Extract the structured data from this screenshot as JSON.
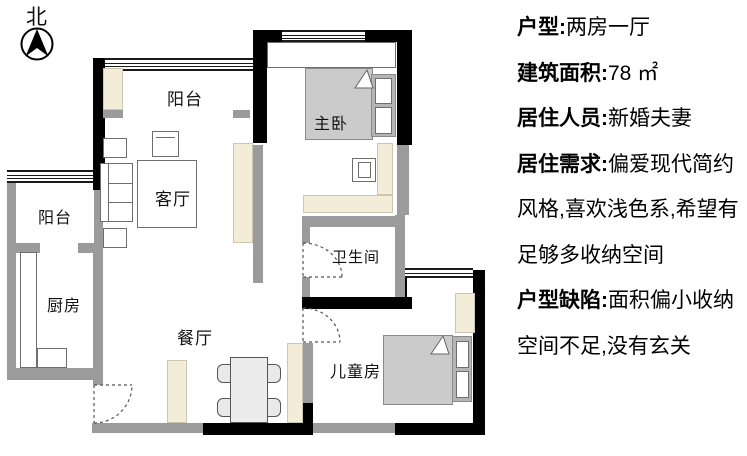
{
  "compass": {
    "label": "北"
  },
  "rooms": [
    {
      "id": "balcony-top",
      "label": "阳台"
    },
    {
      "id": "master-bedroom",
      "label": "主卧"
    },
    {
      "id": "living-room",
      "label": "客厅"
    },
    {
      "id": "balcony-left",
      "label": "阳台"
    },
    {
      "id": "kitchen",
      "label": "厨房"
    },
    {
      "id": "bathroom",
      "label": "卫生间"
    },
    {
      "id": "dining-room",
      "label": "餐厅"
    },
    {
      "id": "kids-room",
      "label": "儿童房"
    }
  ],
  "info_panel": {
    "items": [
      {
        "label": "户型:",
        "value": "两房一厅"
      },
      {
        "label": "建筑面积:",
        "value": "78 ㎡"
      },
      {
        "label": "居住人员:",
        "value": "新婚夫妻"
      },
      {
        "label": "居住需求:",
        "value": "偏爱现代简约风格,喜欢浅色系,希望有足够多收纳空间"
      },
      {
        "label": "户型缺陷:",
        "value": "面积偏小收纳空间不足,没有玄关"
      }
    ]
  },
  "colors": {
    "wall_black": "#000000",
    "wall_gray": "#9b9b9b",
    "furniture_beige": "#f3ecd9",
    "bed_gray": "#cbcbcb",
    "text": "#000000",
    "background": "#ffffff"
  }
}
